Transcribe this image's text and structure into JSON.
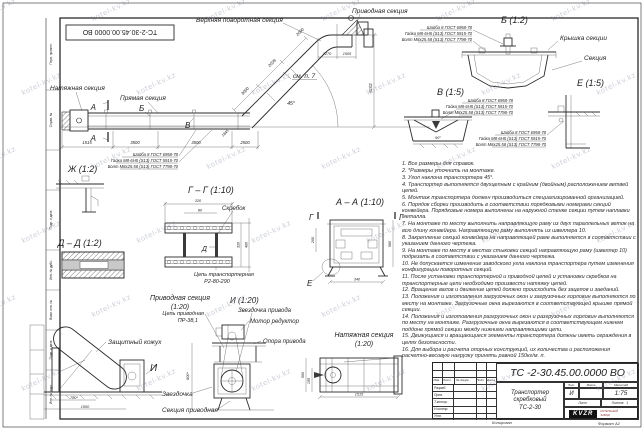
{
  "watermark": {
    "text": "kotel-kv.kz"
  },
  "corner_stamp": {
    "doc_number": "ТС-2-30.45.00.0000 ВО"
  },
  "side_strip": {
    "labels": [
      "Перв. примен.",
      "Справ. №",
      "Подп. и дата",
      "Инв. № дубл.",
      "Взам. инв. №",
      "Подп. и дата",
      "Инв. № подл."
    ]
  },
  "main_view": {
    "upper_section_label": "Верхняя поворотная секция",
    "drive_section_label": "Приводная секция",
    "tension_section_label": "Натяжная секция",
    "straight_section_label": "Прямая секция",
    "see_note": "см. п. 7",
    "angle": "45°",
    "marker_a": "А",
    "marker_b": "Б",
    "marker_v": "В",
    "dim_1515": "1515",
    "dim_3500a": "3500",
    "dim_3500b": "3500",
    "dim_2500": "2500",
    "dim_3000": "3000",
    "dim_2039": "2039",
    "dim_2000": "2000",
    "dim_1845": "1845",
    "dim_1270": "1270",
    "dim_1505": "1505",
    "dim_height": "6102"
  },
  "fasteners": {
    "washer": "Шайба 8 ГОСТ 6958-78",
    "nut": "Гайка М8-6Н5 (S13) ГОСТ 5915-70",
    "bolt": "Болт М8х25.58 (S13) ГОСТ 7798-70"
  },
  "detail_b": {
    "title": "Б (1:2)",
    "cover_label": "Крышка секции",
    "section_label": "Секция"
  },
  "detail_v": {
    "title": "В (1:5)",
    "angle": "90°"
  },
  "detail_e": {
    "title": "Е (1:5)"
  },
  "detail_zh": {
    "title": "Ж (1:2)"
  },
  "detail_gg": {
    "title": "Г – Г (1:10)",
    "scraper_label": "Скребок",
    "marker_d": "Д",
    "chain_label_1": "Цепь транспортерная",
    "chain_label_2": "Р2-80-290",
    "dim_320": "320",
    "dim_80": "80",
    "dim_320b": "320",
    "dim_400": "400"
  },
  "detail_dd": {
    "title": "Д – Д (1:2)"
  },
  "detail_aa": {
    "title": "А – А (1:10)",
    "marker_g": "Г",
    "marker_e": "Е",
    "dim_340": "340",
    "dim_580": "580",
    "dim_200": "200"
  },
  "drive_section": {
    "title": "Приводная секция",
    "scale": "(1:20)",
    "cover_label": "Защитный кожух",
    "sprocket_label": "Звездочка",
    "section_label": "Секция приводная",
    "view_marker": "И",
    "dim_780": "780*",
    "dim_1500": "1500"
  },
  "view_i": {
    "title": "И (1:20)",
    "chain_label_1": "Цепь приводная",
    "chain_label_2": "ПР-38,1",
    "sprocket_label": "Звездочка привода",
    "motor_label": "Мотор редуктор",
    "support_label": "Опора привода",
    "dim_800": "800*"
  },
  "tension_section": {
    "title": "Натяжная секция",
    "scale": "(1:20)",
    "dim_1515": "1515",
    "dim_560": "560",
    "dim_155": "155"
  },
  "notes": [
    "1. Все размеры для справок.",
    "2. *Размеры уточнить на монтаже.",
    "3. Угол наклона транспортера 45°.",
    "4. Транспортер выполняется двухцепным с крайним (двойным) расположением ветвей цепей.",
    "5. Монтаж транспортера должен производиться специализированной организацией.",
    "6. Порядок сборки производить в соответствии порядковыми номерами секций конвейера. Порядковые номера выполнены на наружной стенке секции путем наплавки металла.",
    "7. На монтаже по месту выполнить направляющую раму из двух параллельных веток на всю длину конвейера. Направляющую раму выполнять из швеллера 10.",
    "8. Закрепление секций конвейера на направляющей раме выполняется в соответствии с указанием данного чертежа.",
    "9. На монтаже по месту в местах стыковки секций направляющую раму (швеллер 10) подрезать в соответствии с указанием данного чертежа.",
    "10. Не допускается изменение заводского угла наклона транспортера путем изменения конфигурации поворотных секций.",
    "11. После установки транспортерной и приводной цепей и установки скребков на транспортерные цепи необходимо произвести натяжку цепей.",
    "12. Вращение валов и движение цепей должно происходить без зацепов и заеданий.",
    "13. Положения и изготовления загрузочных окон и загрузочных горловин выполняются по месту на монтаже. Загрузочные окна вырезаются в соответствующей крышке прямой секции.",
    "14. Положения и изготовления разгрузочных окон и разгрузочных горловин выполняются по месту на монтаже. Разгрузочные окна вырезаются в соответствующем нижнем поддоне прямой секции между нижними направляющими цепи.",
    "15. Движущиеся и вращающиеся элементы транспортера должны иметь ограждения в целях безопасности.",
    "16. Для выбора и расчета опорных конструкций, их количества и расположения расчетно-весовую нагрузку принять равной 150кг/м. п."
  ],
  "title_block": {
    "doc_number": "ТС -2-30.45.00.0000  ВО",
    "name_line1": "Транспортер",
    "name_line2": "скребковый",
    "name_line3": "ТС-2-30",
    "col_izm": "Изм.",
    "col_list": "Лист",
    "col_doc": "№ докум.",
    "col_sign": "Подп.",
    "col_date": "Дата",
    "row_developed": "Разраб.",
    "row_checked": "Пров.",
    "row_tcontrol": "Т.контр.",
    "row_ncontrol": "Н.контр.",
    "row_approved": "Утв.",
    "lit_label": "Лит.",
    "mass_label": "Масса",
    "scale_label": "Масштаб",
    "lit_value": "И",
    "scale_value": "1:75",
    "sheet_label": "Лист",
    "sheets_label": "Листов",
    "sheets_value": "1",
    "logo_text": "KVZR",
    "logo_sub1": "КОТЕЛЬНЫЙ",
    "logo_sub2": "ЗАВОД",
    "copied_label": "Копировал",
    "format_label": "Формат А2"
  }
}
